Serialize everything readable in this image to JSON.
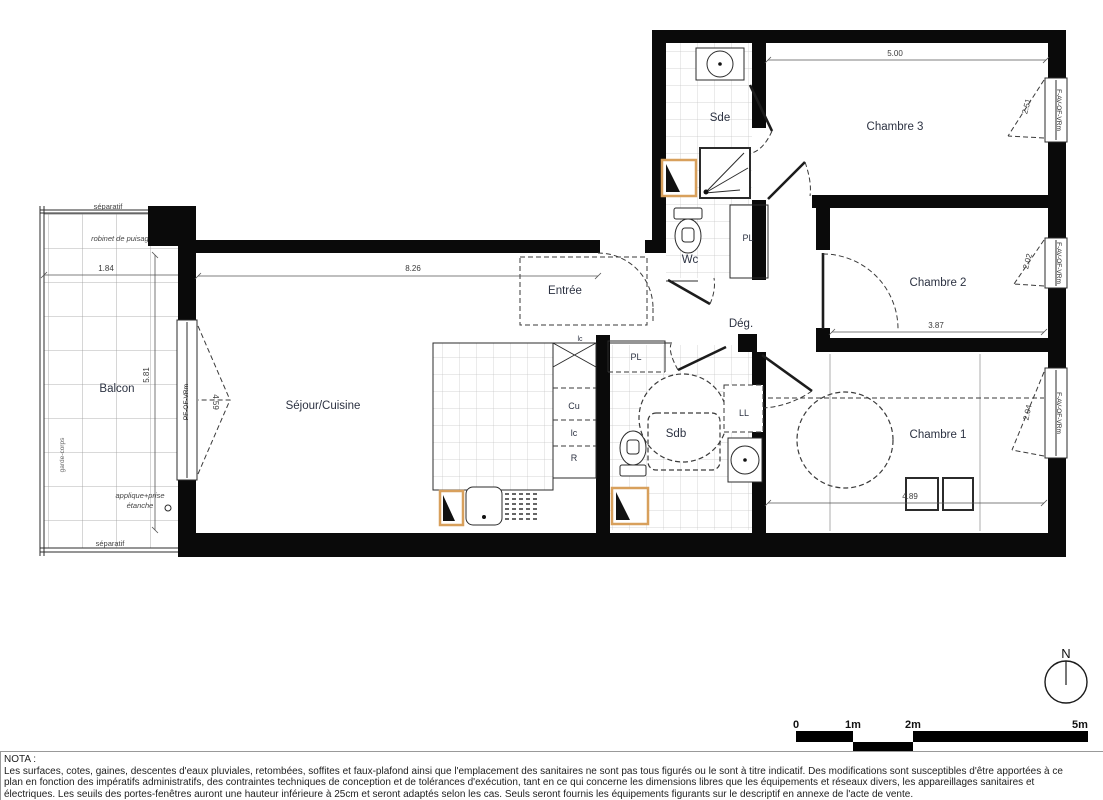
{
  "rooms": {
    "balcon": "Balcon",
    "sejour": "Séjour/Cuisine",
    "entree": "Entrée",
    "sde": "Sde",
    "wc": "Wc",
    "deg": "Dég.",
    "sdb": "Sdb",
    "chambre1": "Chambre 1",
    "chambre2": "Chambre 2",
    "chambre3": "Chambre 3"
  },
  "fixtures": {
    "pl_hall": "PL",
    "pl_sejour": "PL",
    "ll": "LL",
    "cu": "Cu",
    "lc_top": "lc",
    "lc": "lc",
    "r": "R"
  },
  "dimensions": {
    "chambre3_width": "5.00",
    "sejour_width": "8.26",
    "balcon_width": "1.84",
    "balcon_length": "5.81",
    "sejour_window": "4.59",
    "chambre2_width": "3.87",
    "chambre1_width": "4.89",
    "chambre3_window": "2.51",
    "chambre2_window": "2.02",
    "chambre1_window": "2.04"
  },
  "annotations": {
    "separatif_top": "séparatif",
    "separatif_bottom": "séparatif",
    "robinet": "robinet de puisage",
    "garde_corps": "garde-corps",
    "applique_line1": "applique+prise",
    "applique_line2": "étanche"
  },
  "windows": {
    "sejour": "PF-OF-VRm",
    "chambre3": "F-AV-OF-VRm",
    "chambre2": "F-AV-OF-VRm",
    "chambre1": "F-AV-OF-VRm"
  },
  "scale_bar": {
    "labels": [
      "0",
      "1m",
      "2m",
      "5m"
    ]
  },
  "compass": {
    "north_label": "N"
  },
  "nota": {
    "title": "NOTA :",
    "lines": [
      "Les surfaces, cotes, gaines, descentes d'eaux pluviales, retombées, soffites et faux-plafond ainsi que l'emplacement des sanitaires ne sont pas tous figurés ou le sont à titre indicatif. Des modifications sont susceptibles d'être apportées à ce",
      "plan en fonction des impératifs administratifs, des contraintes techniques de conception et de tolérances d'exécution, tant en ce qui concerne les dimensions libres que les équipements et réseaux divers, les appareillages sanitaires et",
      "électriques. Les seuils des portes-fenêtres auront une hauteur inférieure à 25cm et seront adaptés selon les cas. Seuls seront fournis les équipements figurants sur le descriptif en annexe de l'acte de vente."
    ]
  },
  "colors": {
    "wall": "#0a0a0a",
    "highlight_joinery": "#d8a05c",
    "room_label": "#2c3242"
  }
}
